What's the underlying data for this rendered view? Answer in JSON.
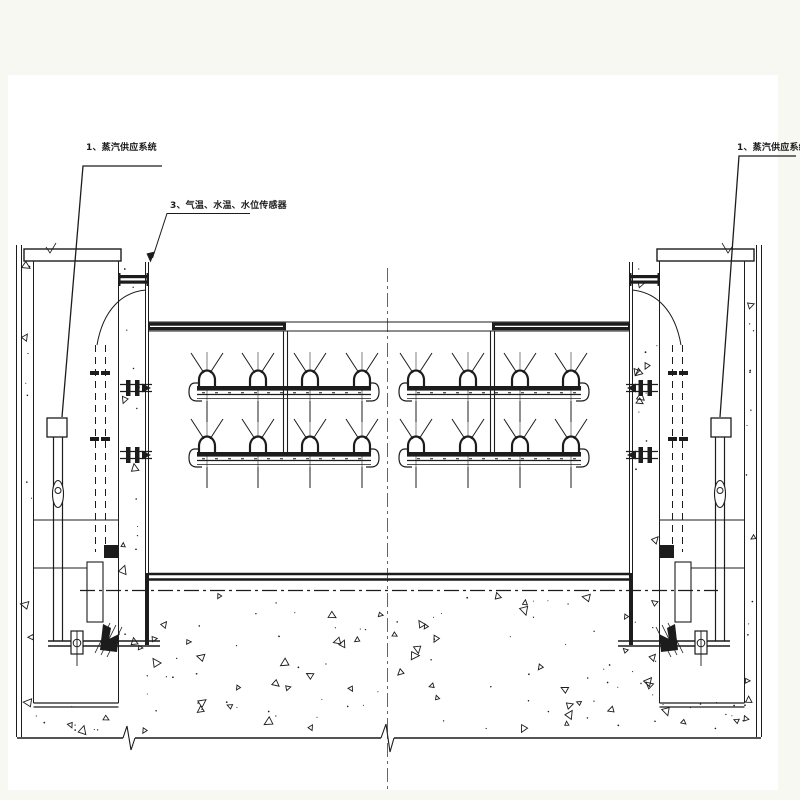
{
  "page": {
    "background_color": "#f6f8f1",
    "canvas_color": "#ffffff",
    "ink_color": "#1c1c1c",
    "drawing_type": "engineering CAD front elevation"
  },
  "labels": {
    "steam_left": "1、蒸汽供应系统",
    "sensors": "3、气温、水温、水位传感器",
    "steam_right": "1、蒸汽供应系统"
  },
  "components": {
    "left_pier": "concrete side pier (left)",
    "right_pier": "concrete side pier (right)",
    "gate_panel": "gate panel with steam spray pipe assemblies",
    "nozzle_rows": 4,
    "nozzles_per_row": 4,
    "hoist_cylinders": 2,
    "foundation": "concrete foundation slab with centerline break marks"
  }
}
